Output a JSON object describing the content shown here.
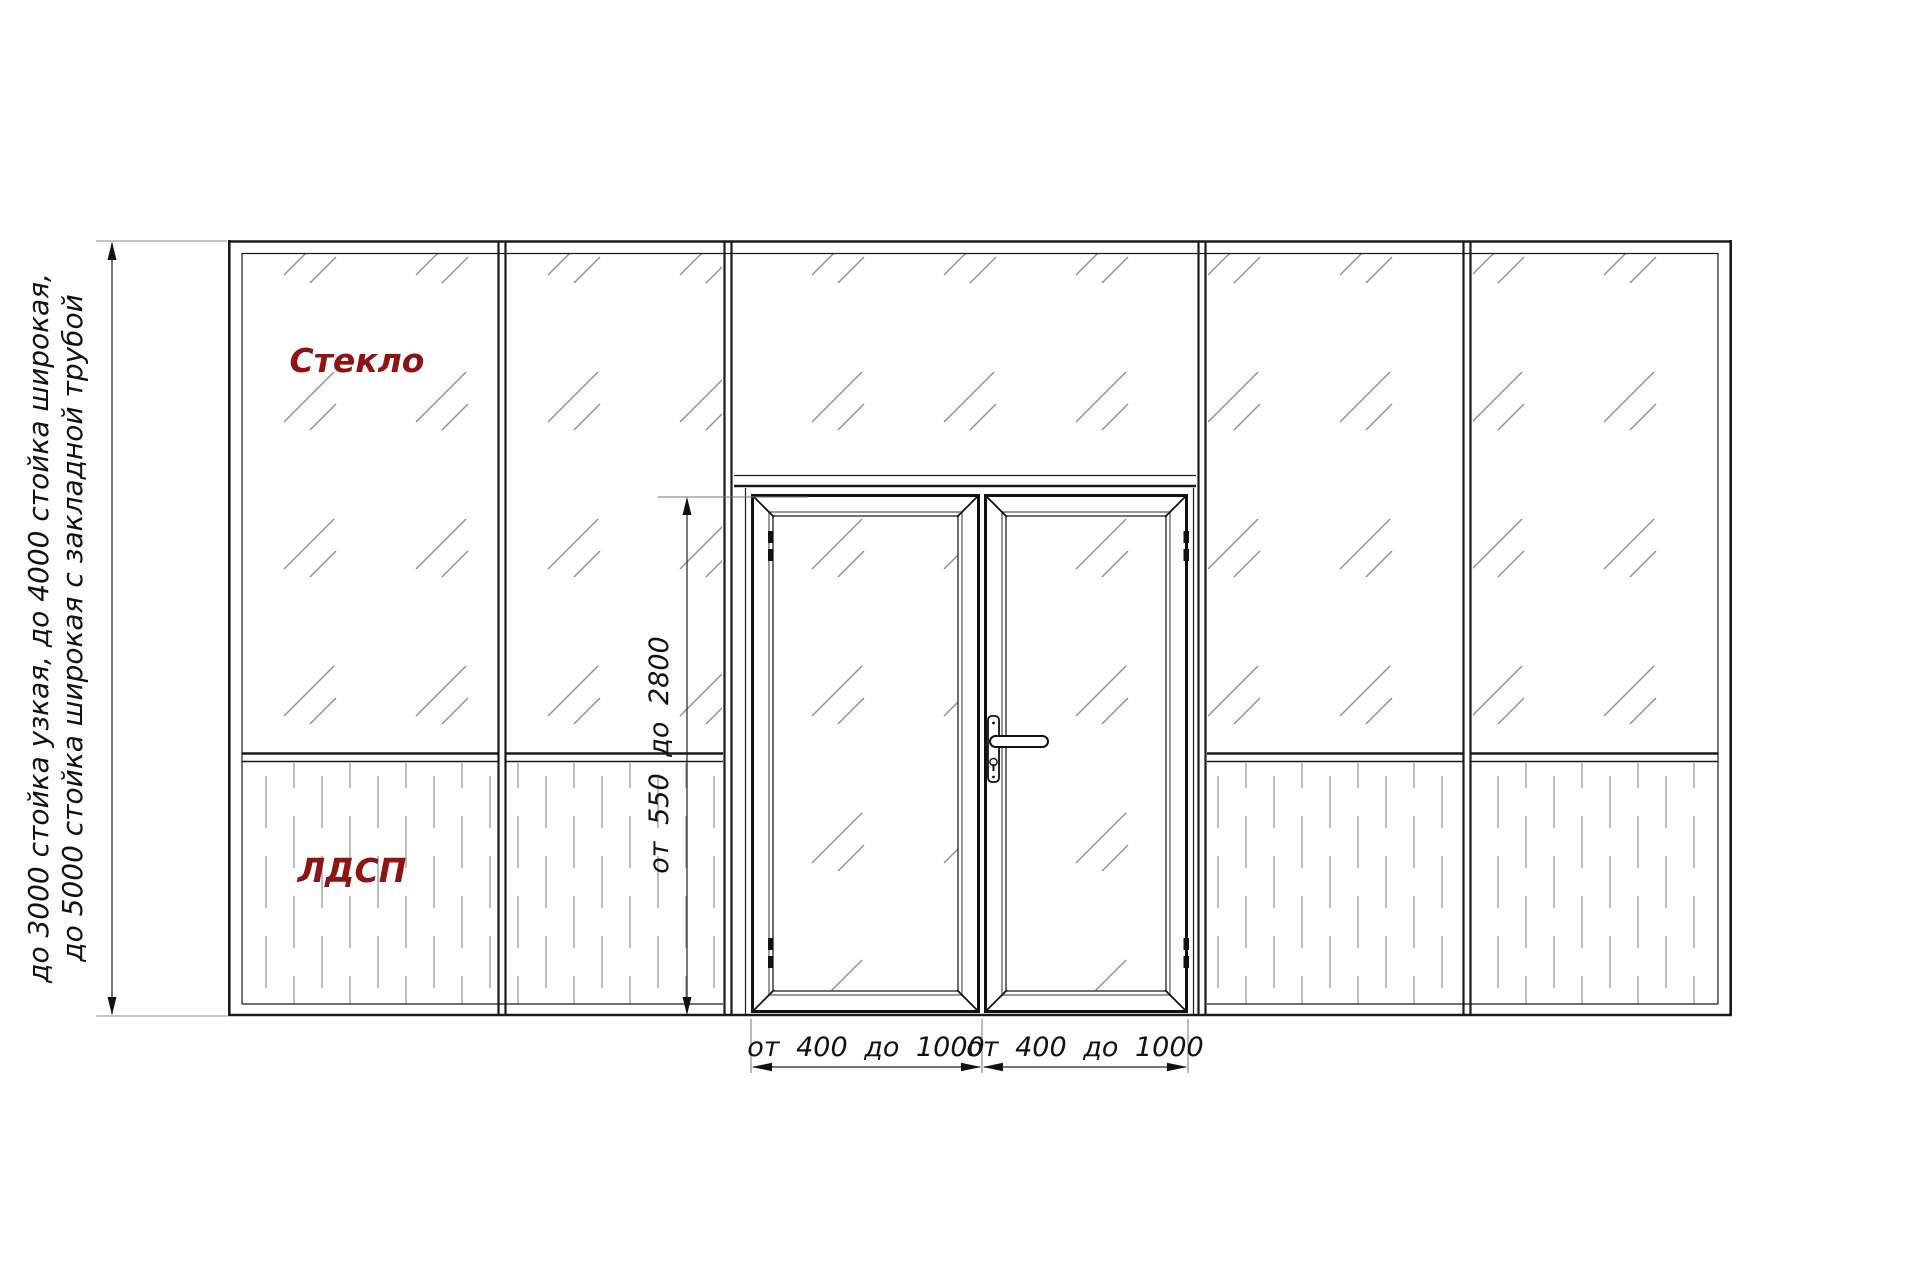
{
  "drawing": {
    "annotation_left": {
      "line1": "до 3000 стойка узкая, до 4000 стойка широкая,",
      "line2": "до 5000 стойка широкая с закладной трубой"
    },
    "labels": {
      "glass": "Стекло",
      "panel": "ЛДСП"
    },
    "dimensions": {
      "door_height": "от 550 до 2800",
      "door_leaf_width_left": "от 400 до 1000",
      "door_leaf_width_right": "от 400 до 1000"
    },
    "colors": {
      "line": "#1a1a1a",
      "material_label": "#8e1414",
      "glass_hatch": "#8f8f8f",
      "panel_hatch": "#a8a8a8"
    }
  }
}
